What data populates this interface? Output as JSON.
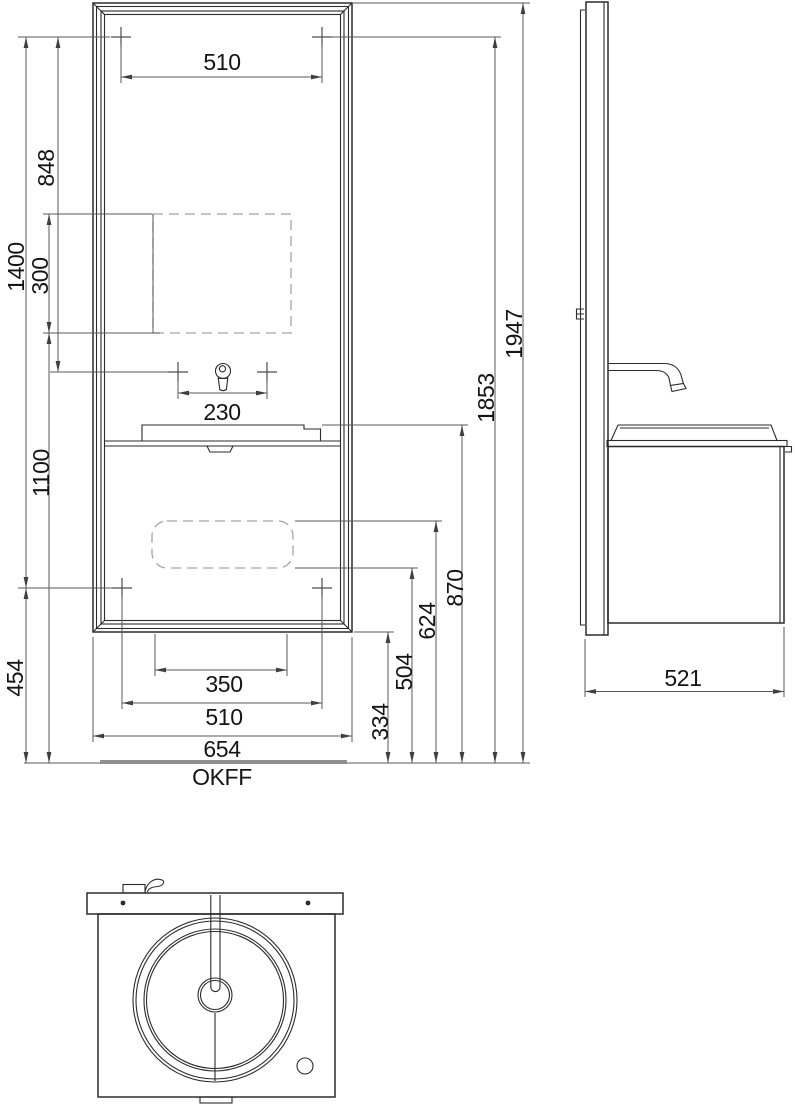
{
  "page": {
    "background": "#ffffff",
    "line_color": "#2b2b2b",
    "dim_color": "#5a5a5a",
    "dashed_color": "#a3a3a3",
    "floor_color": "#8f8f8f"
  },
  "front_view": {
    "dim_top_mount_width": "510",
    "dim_faucet_spacing": "230",
    "dim_mirror_mount_drop": "848",
    "dim_niche_height": "300",
    "dim_mount_span": "1400",
    "dim_niche_bottom_height": "1100",
    "dim_lower_mount_height": "454",
    "dim_cutout_width": "350",
    "dim_lower_mount_width": "510",
    "dim_total_width": "654",
    "dim_cabinet_bottom_height": "334",
    "dim_cutout_bottom_height": "504",
    "dim_cutout_top_height": "624",
    "dim_basin_top_height": "870",
    "dim_upper_mount_height": "1853",
    "dim_total_height": "1947",
    "floor_label": "OKFF"
  },
  "side_view": {
    "dim_depth": "521"
  }
}
